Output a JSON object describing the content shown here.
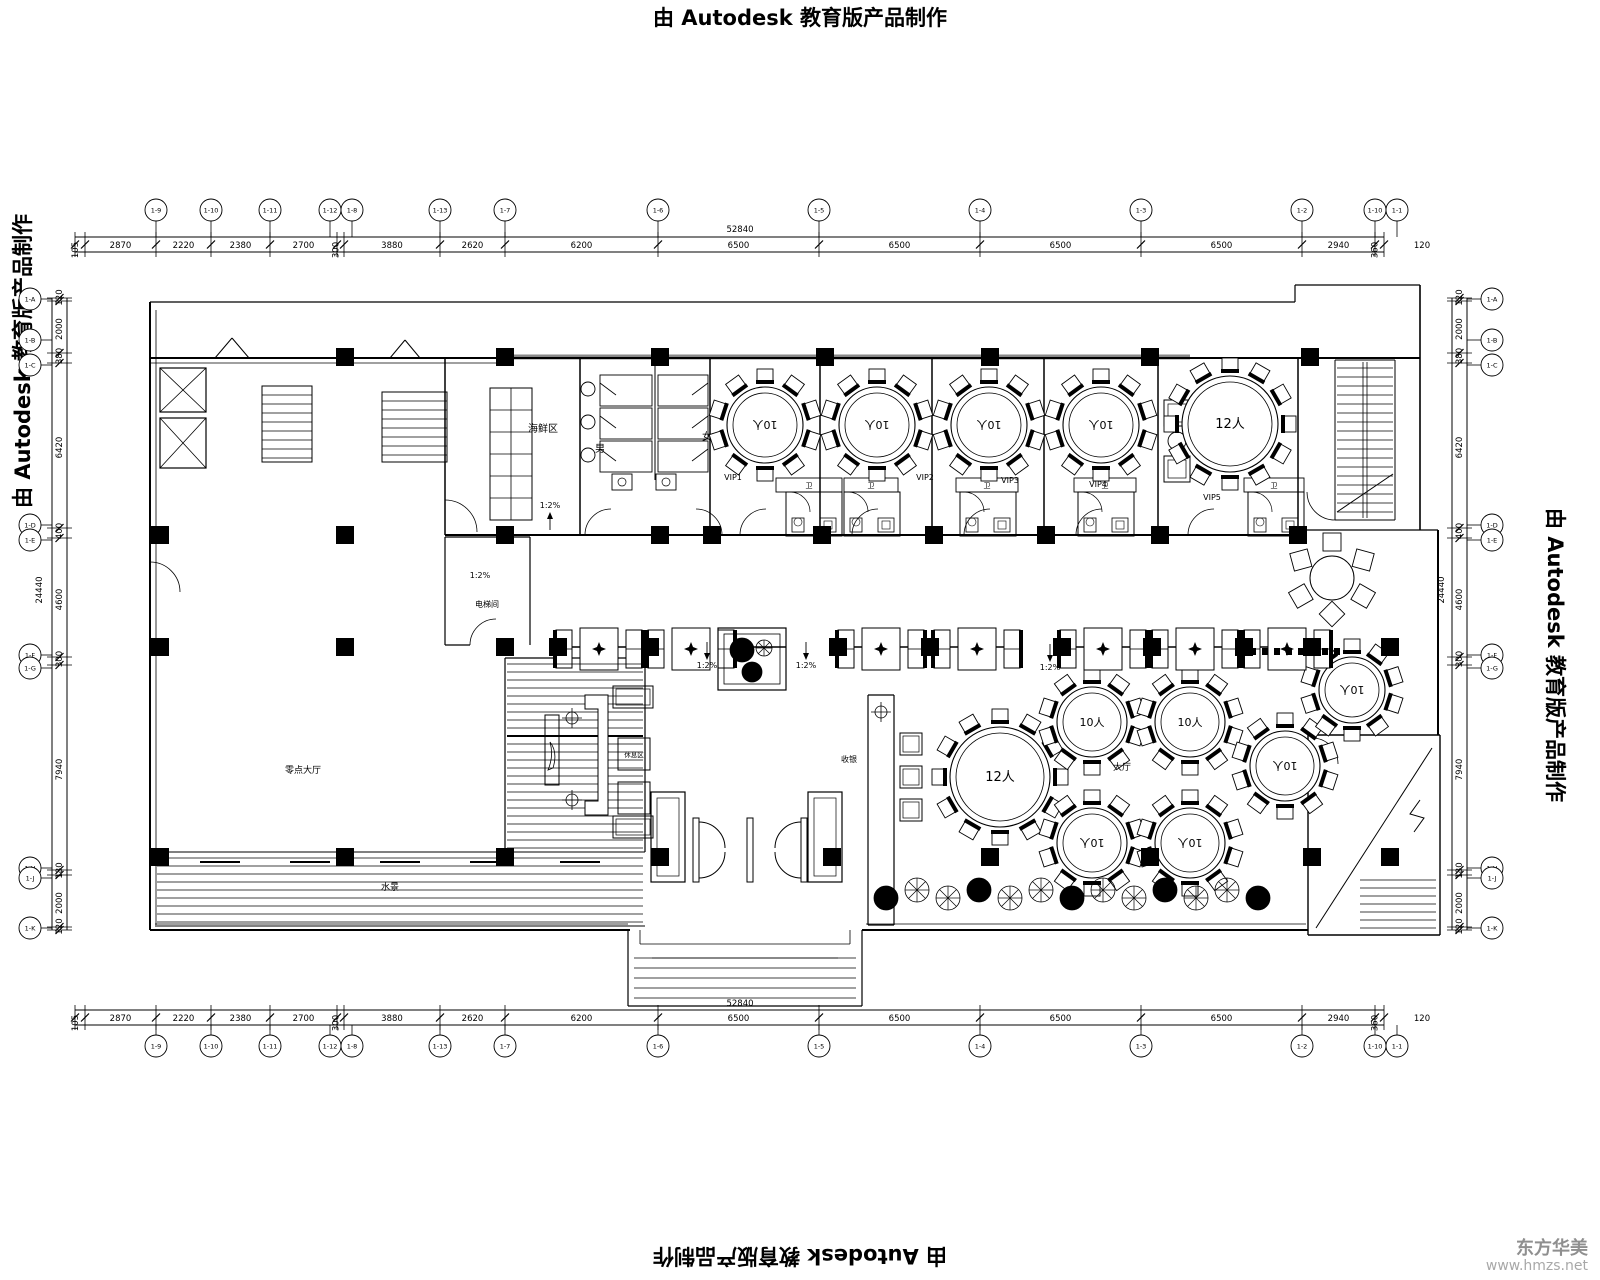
{
  "border_text": {
    "top": "由 Autodesk 教育版产品制作",
    "bottom": "由 Autodesk 教育版产品制作",
    "left": "由 Autodesk 教育版产品制作",
    "right": "由 Autodesk 教育版产品制作"
  },
  "watermark": {
    "line1": "东方华美",
    "line2": "www.hmzs.net"
  },
  "dimensions": {
    "top": {
      "total": "52840",
      "trailing": "120",
      "segments": [
        "105",
        "2870",
        "2220",
        "2380",
        "2700",
        "300",
        "3880",
        "2620",
        "6200",
        "6500",
        "6500",
        "6500",
        "6500",
        "2940",
        "360"
      ]
    },
    "bottom": {
      "total": "52840",
      "trailing": "120",
      "segments": [
        "105",
        "2870",
        "2220",
        "2380",
        "2700",
        "300",
        "3880",
        "2620",
        "6200",
        "6500",
        "6500",
        "6500",
        "6500",
        "2940",
        "360"
      ]
    },
    "left": {
      "total": "24440",
      "segments": [
        "120",
        "2000",
        "380",
        "6420",
        "400",
        "4600",
        "300",
        "7940",
        "180",
        "2000",
        "120"
      ]
    },
    "right": {
      "total": "24440",
      "segments": [
        "120",
        "2000",
        "380",
        "6420",
        "400",
        "4600",
        "300",
        "7940",
        "180",
        "2000",
        "120"
      ]
    }
  },
  "grid_bubbles": {
    "top": [
      "1-9",
      "1-10",
      "1-11",
      "1-12",
      "1-8",
      "1-13",
      "1-7",
      "1-6",
      "1-5",
      "1-4",
      "1-3",
      "1-2",
      "1-10",
      "1-1"
    ],
    "bottom": [
      "1-9",
      "1-10",
      "1-11",
      "1-12",
      "1-8",
      "1-13",
      "1-7",
      "1-6",
      "1-5",
      "1-4",
      "1-3",
      "1-2",
      "1-10",
      "1-1"
    ],
    "left": [
      "1-A",
      "1-B",
      "1-C",
      "1-D",
      "1-E",
      "1-F",
      "1-G",
      "1-H",
      "1-J",
      "1-K"
    ],
    "right": [
      "1-A",
      "1-B",
      "1-C",
      "1-D",
      "1-E",
      "1-F",
      "1-G",
      "1-H",
      "1-J",
      "1-K"
    ]
  },
  "rooms": {
    "seafood": "海鲜区",
    "men": "男",
    "women": "女",
    "vip1": "VIP1",
    "vip2": "VIP2",
    "vip3": "VIP3",
    "vip4": "VIP4",
    "vip5": "VIP5",
    "pantry": "电梯间",
    "hall_left": "零点大厅",
    "lounge": "休息区",
    "water": "水景",
    "cashier": "收银",
    "hall_main": "大厅",
    "bath": "卫"
  },
  "tables": {
    "t10": "10人",
    "t12": "12人"
  },
  "annotations": {
    "slope": "1:2%"
  },
  "drawing_colors": {
    "line": "#000000",
    "band": "#8a8a8a",
    "watermark": "#9a9a9a"
  }
}
